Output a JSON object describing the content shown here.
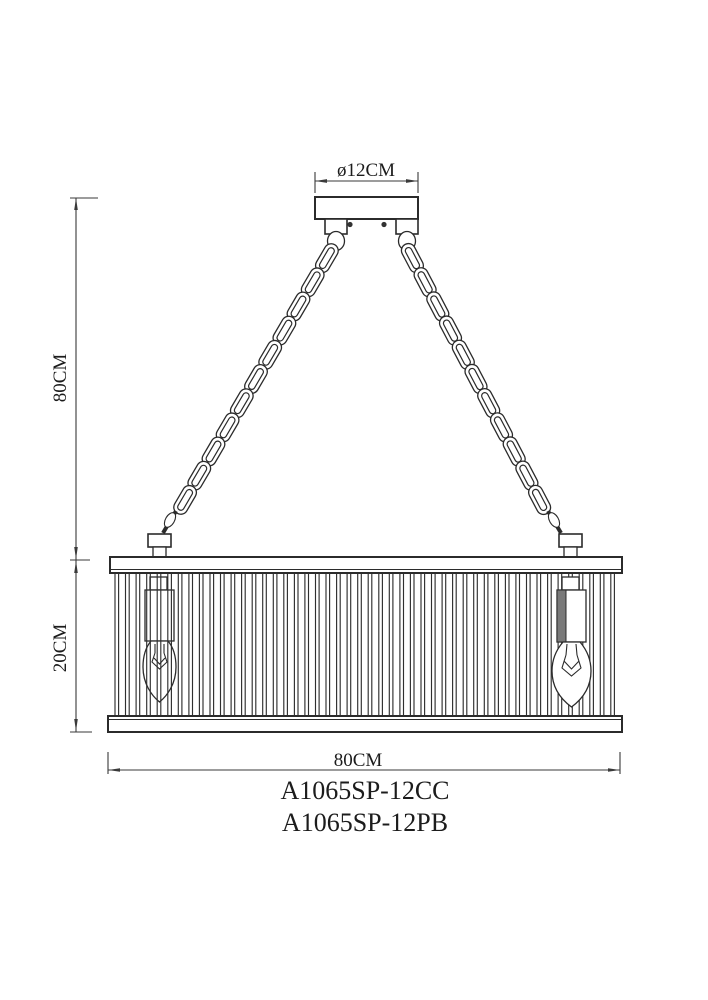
{
  "drawing": {
    "kind": "pendant-chandelier-dimension-drawing",
    "labels": {
      "canopy_diameter": "ø12CM",
      "chain_height": "80CM",
      "shade_height": "20CM",
      "shade_width": "80CM"
    },
    "model_numbers": [
      "A1065SP-12CC",
      "A1065SP-12PB"
    ],
    "colors": {
      "background": "#ffffff",
      "line": "#2b2b2b",
      "dimension_line": "#3a3a3a",
      "text": "#1c1c1c",
      "socket_shading": "#7a7a7a"
    }
  }
}
